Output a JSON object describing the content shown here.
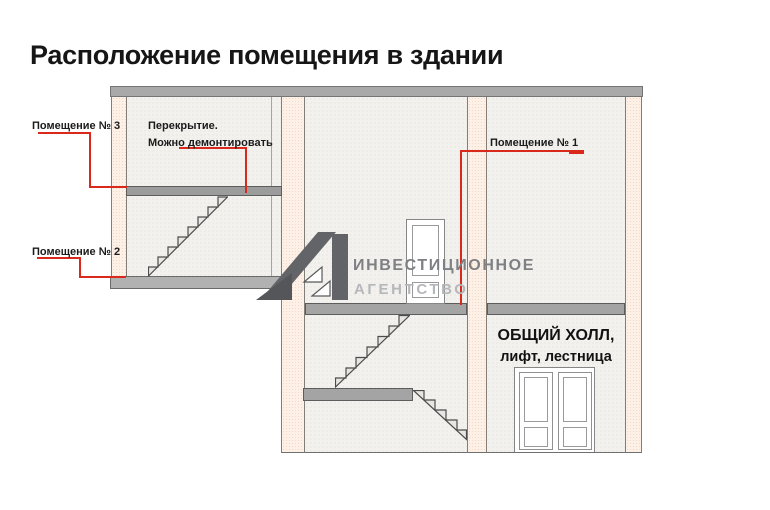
{
  "title": "Расположение помещения в здании",
  "annotations": {
    "room3": {
      "label": "Помещение № 3"
    },
    "room2": {
      "label": "Помещение № 2"
    },
    "room1": {
      "label": "Помещение № 1"
    },
    "ceiling_note": {
      "line1": "Перекрытие.",
      "line2": "Можно демонтировать"
    },
    "hall": {
      "line1": "ОБЩИЙ ХОЛЛ,",
      "line2": "лифт, лестница"
    }
  },
  "watermark": {
    "line1": "ИНВЕСТИЦИОННОЕ",
    "line2": "АГЕНТСТВО",
    "logo": "a1-logo"
  },
  "colors": {
    "annotation_red": "#d9291c",
    "wall_fill": "#fdf0e7",
    "interior_fill": "#f2f1ee",
    "slab_gray": "#a4a4a4",
    "logo_gray": "#626468",
    "watermark_text": "#7e8084",
    "watermark_text_light": "#b5b7ba"
  }
}
